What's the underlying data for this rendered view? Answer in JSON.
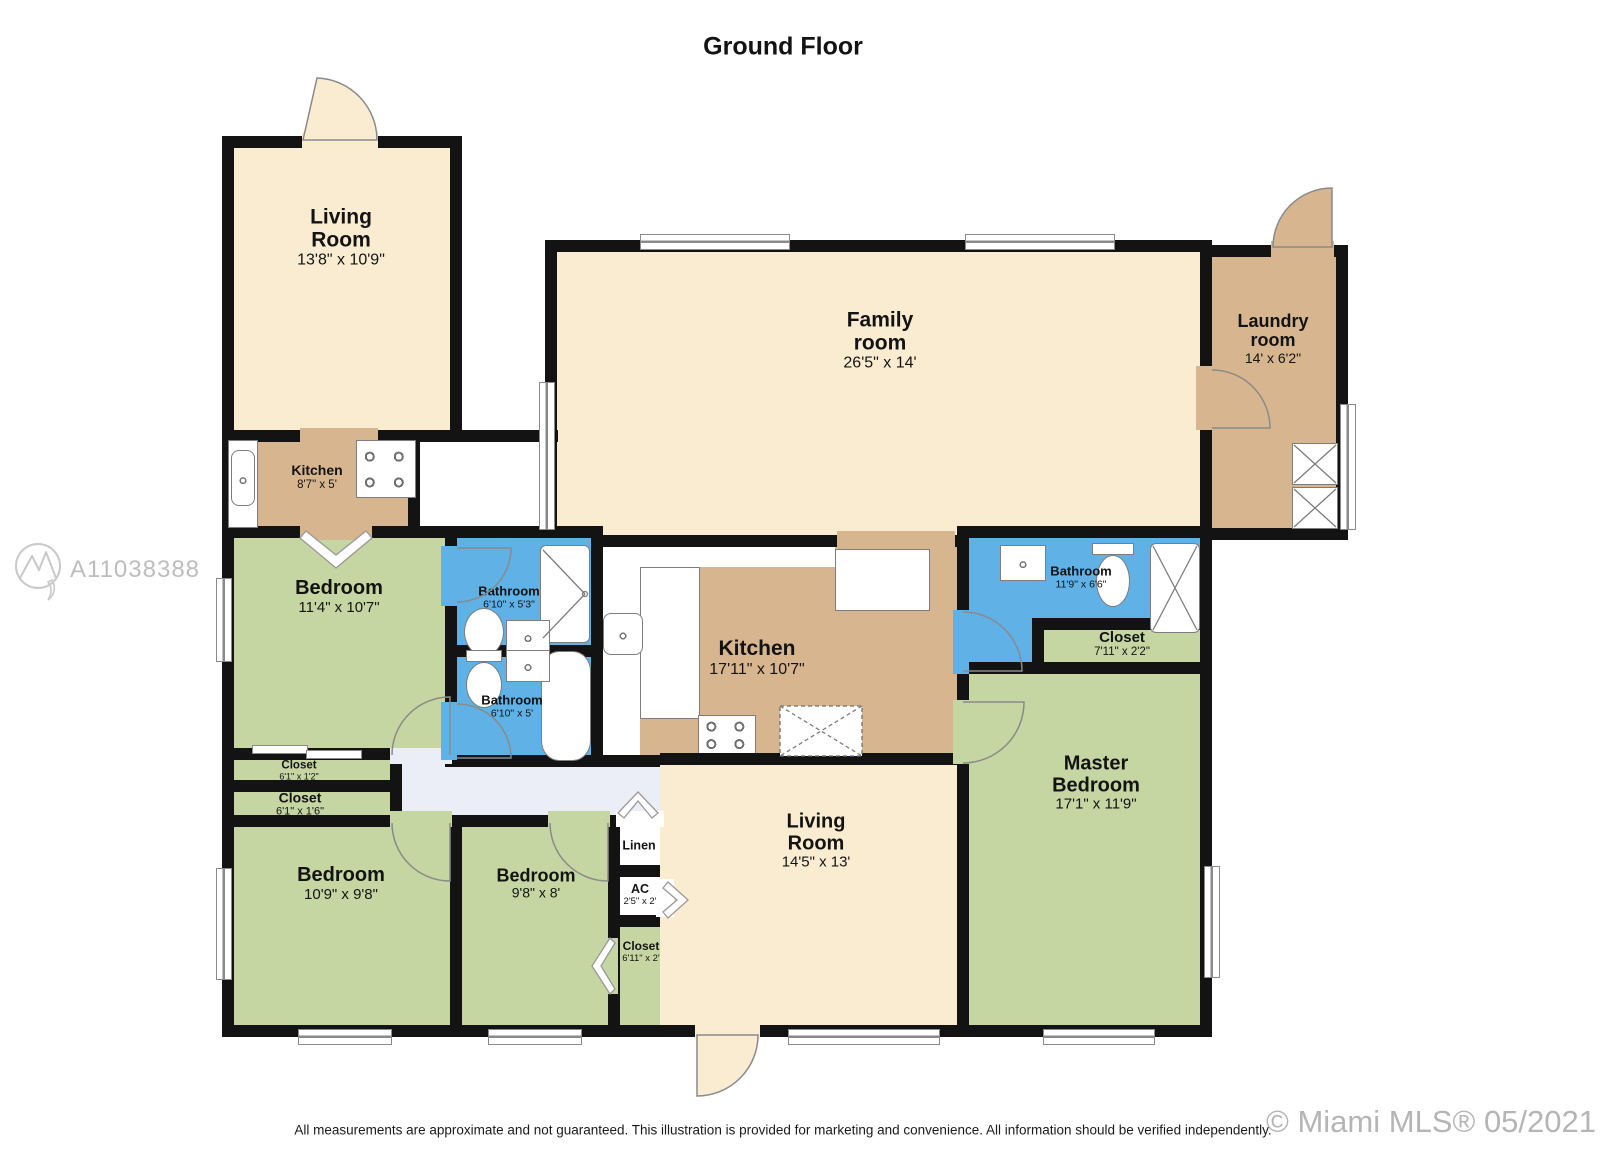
{
  "page": {
    "title": "Ground Floor",
    "watermark_id": "A11038388",
    "watermark_mls": "© Miami MLS® 05/2021",
    "disclaimer": "All measurements are approximate and not guaranteed. This illustration is provided for marketing and convenience. All information should be verified independently."
  },
  "colors": {
    "cream_room": "#faecd1",
    "tan_room": "#d7b68f",
    "green_room": "#c5d6a2",
    "blue_room": "#5fb1e6",
    "wall": "#131313",
    "hallway": "#eceef7",
    "fixture_stroke": "#7d7d7d",
    "watermark_gray": "#bdbdbd"
  },
  "rooms": {
    "lr_upper": {
      "name": "Living Room",
      "dims": "13'8\" x 10'9\""
    },
    "kitchen_small": {
      "name": "Kitchen",
      "dims": "8'7\" x 5'"
    },
    "family": {
      "name": "Family room",
      "dims": "26'5\" x 14'"
    },
    "laundry": {
      "name": "Laundry room",
      "dims": "14' x 6'2\""
    },
    "bedroom_left": {
      "name": "Bedroom",
      "dims": "11'4\" x 10'7\""
    },
    "bath_upper": {
      "name": "Bathroom",
      "dims": "6'10\" x 5'3\""
    },
    "bath_lower": {
      "name": "Bathroom",
      "dims": "6'10\" x 5'"
    },
    "kitchen_main": {
      "name": "Kitchen",
      "dims": "17'11\" x 10'7\""
    },
    "bath_master": {
      "name": "Bathroom",
      "dims": "11'9\" x 6'6\""
    },
    "closet_master": {
      "name": "Closet",
      "dims": "7'11\" x 2'2\""
    },
    "master": {
      "name": "Master Bedroom",
      "dims": "17'1\" x 11'9\""
    },
    "closet1": {
      "name": "Closet",
      "dims": "6'1\" x 1'2\""
    },
    "closet2": {
      "name": "Closet",
      "dims": "6'1\" x 1'6\""
    },
    "bedroom_bl": {
      "name": "Bedroom",
      "dims": "10'9\" x 9'8\""
    },
    "bedroom_bm": {
      "name": "Bedroom",
      "dims": "9'8\" x 8'"
    },
    "linen": {
      "name": "Linen",
      "dims": ""
    },
    "ac": {
      "name": "AC",
      "dims": "2'5\" x 2'"
    },
    "closet_center": {
      "name": "Closet",
      "dims": "6'11\" x 2'"
    },
    "lr_lower": {
      "name": "Living Room",
      "dims": "14'5\" x 13'"
    }
  }
}
